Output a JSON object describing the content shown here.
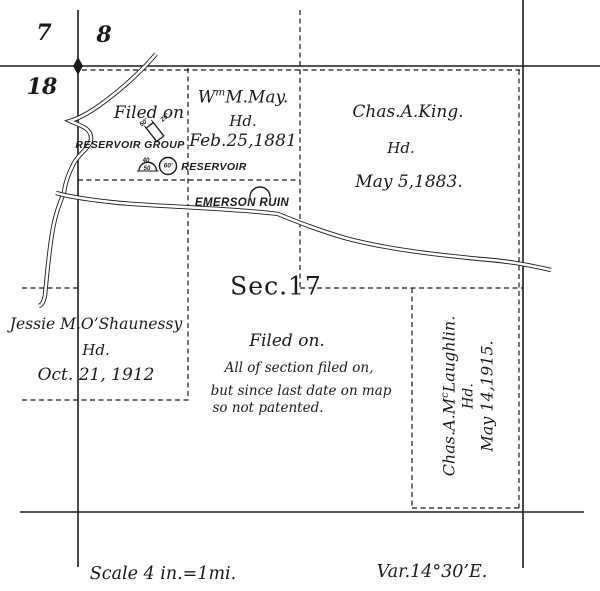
{
  "map": {
    "section_numbers": {
      "nw": "7",
      "ne": "8",
      "sw": "18",
      "center": "Sec.17"
    },
    "claims": {
      "may": {
        "name_pre": "W",
        "name_sup": "m",
        "name_post": "M.May.",
        "line2": "Hd.",
        "line3": "Feb.25,1881"
      },
      "king": {
        "line1": "Chas.A.King.",
        "line2": "Hd.",
        "line3": "May 5,1883."
      },
      "oshaunessy": {
        "line1": "Jessie M.O’Shaunessy",
        "line2": "Hd.",
        "line3": "Oct. 21, 1912"
      },
      "mclaughlin": {
        "name_pre": "Chas.A.M",
        "name_sup": "c",
        "name_post": "Laughlin.",
        "line2": "Hd.",
        "line3": "May 14,1915."
      }
    },
    "notes": {
      "filed_on_upper": "Filed on",
      "filed_on_center": "Filed on.",
      "note_line1": "All of section filed on,",
      "note_line2": "but since last date on map",
      "note_line3": "so not patented."
    },
    "features": {
      "reservoir_group": "RESERVOIR GROUP",
      "reservoir": "RESERVOIR",
      "emerson_ruin": "EMERSON RUIN",
      "dim_50": "50'",
      "dim_25": "25'",
      "dim_40": "40",
      "dim_50b": "50",
      "dim_60": "60'"
    },
    "footer": {
      "scale": "Scale 4 in.=1mi.",
      "variation": "Var.14°30’E."
    },
    "colors": {
      "ink": "#1b1b1b",
      "paper": "#ffffff"
    }
  }
}
